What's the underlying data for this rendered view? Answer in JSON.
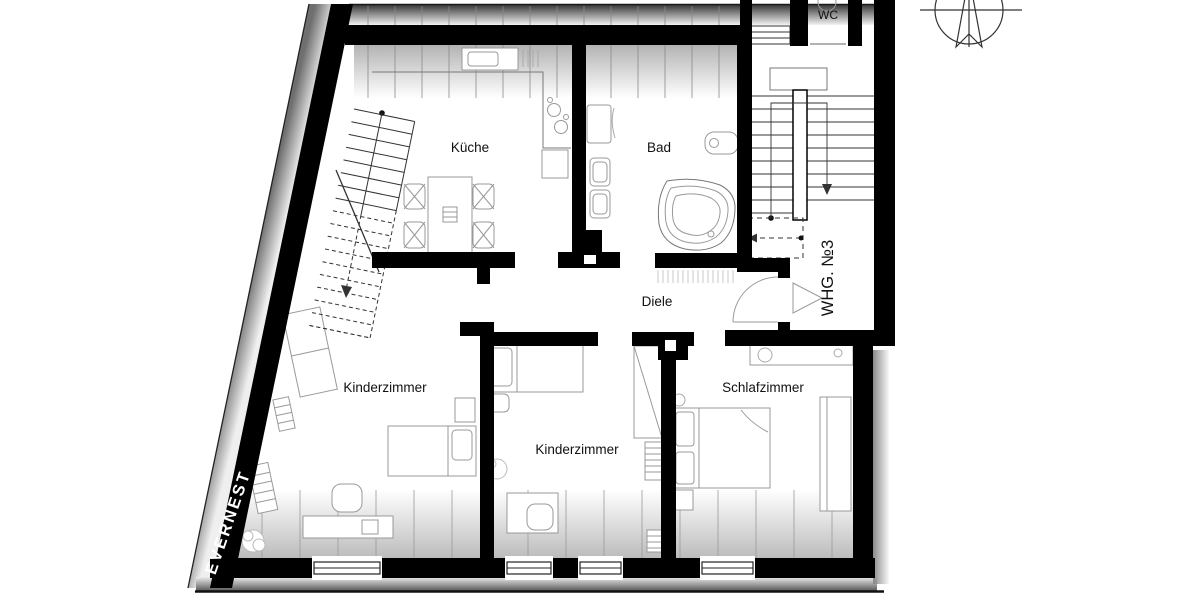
{
  "plan": {
    "type": "floor-plan",
    "labels": {
      "kitchen": "Küche",
      "bath": "Bad",
      "hall": "Diele",
      "child_room_left": "Kinderzimmer",
      "child_room_center": "Kinderzimmer",
      "bedroom": "Schlafzimmer",
      "wc": "WC",
      "apartment": "WHG. №3"
    },
    "watermark": "EVERNEST",
    "colors": {
      "wall": "#000000",
      "furniture_line": "#999999",
      "stair_line": "#333333",
      "paper": "#ffffff"
    }
  }
}
